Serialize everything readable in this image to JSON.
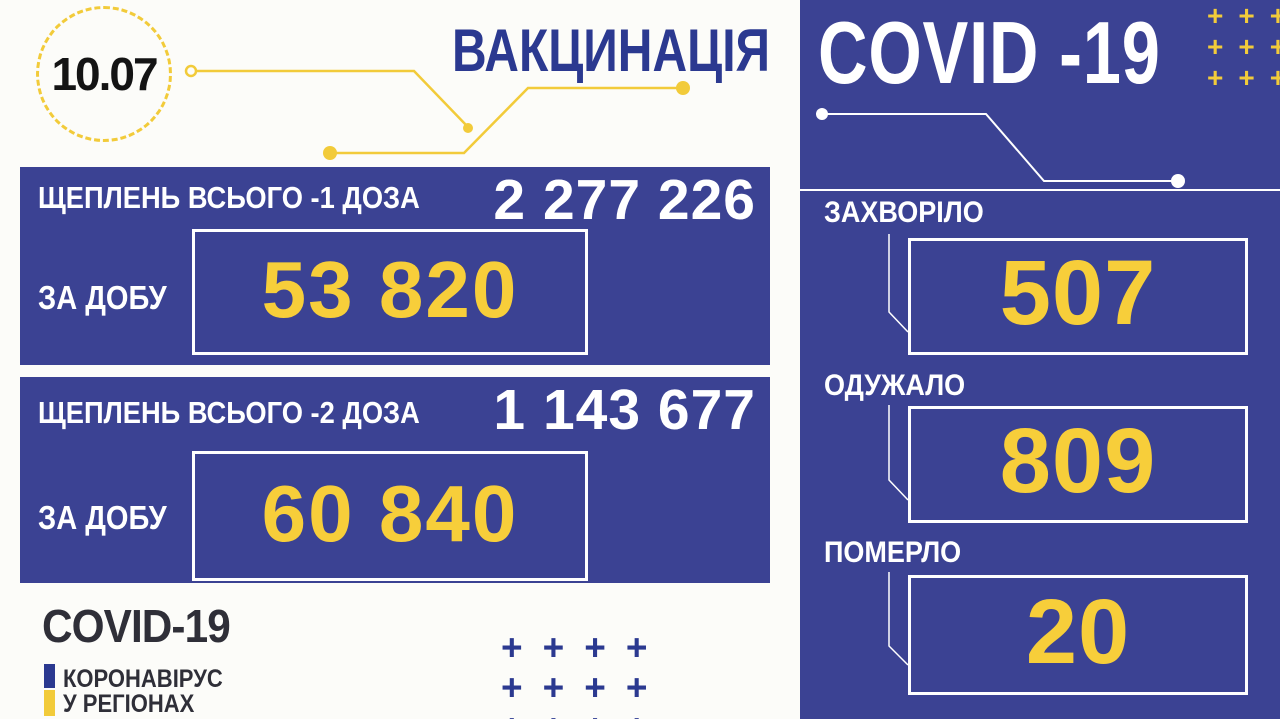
{
  "header": {
    "date": "10.07",
    "title": "ВАКЦИНАЦІЯ"
  },
  "vaccination": {
    "panels": [
      {
        "total_label": "ЩЕПЛЕНЬ ВСЬОГО -1 ДОЗА",
        "total_value": "2 277 226",
        "daily_label": "ЗА ДОБУ",
        "daily_value": "53 820"
      },
      {
        "total_label": "ЩЕПЛЕНЬ ВСЬОГО -2 ДОЗА",
        "total_value": "1 143 677",
        "daily_label": "ЗА ДОБУ",
        "daily_value": "60 840"
      }
    ]
  },
  "branding": {
    "title": "COVID-19",
    "subtitle_line1": "КОРОНАВІРУС",
    "subtitle_line2": "У РЕГІОНАХ"
  },
  "covid": {
    "title": "COVID -19",
    "stats": [
      {
        "label": "ЗАХВОРІЛО",
        "value": "507"
      },
      {
        "label": "ОДУЖАЛО",
        "value": "809"
      },
      {
        "label": "ПОМЕРЛО",
        "value": "20"
      }
    ]
  },
  "decorations": {
    "plus_glyph": "+"
  },
  "colors": {
    "panel_blue": "#3B4293",
    "accent_yellow": "#F7CE3A",
    "connector_yellow": "#F2CB3A",
    "navy_text": "#2B3990",
    "white": "#FFFFFF",
    "black_text": "#141414"
  }
}
